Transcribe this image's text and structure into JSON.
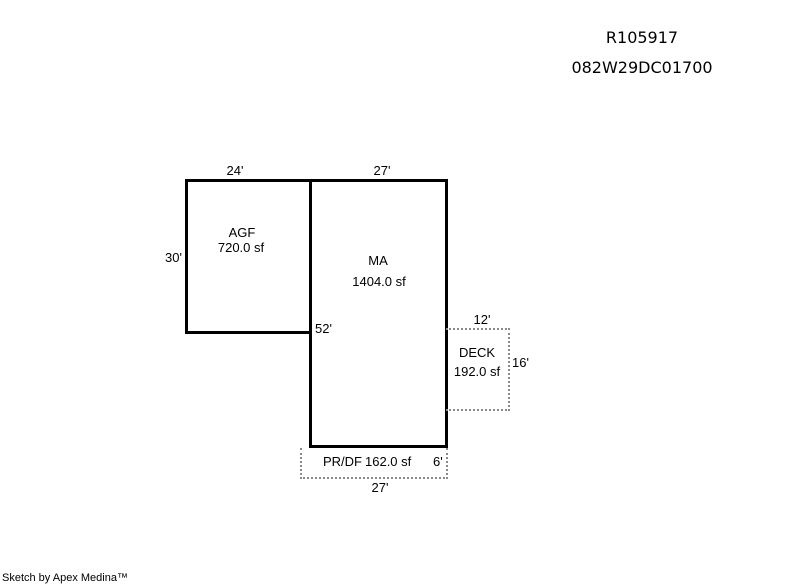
{
  "header": {
    "account_number": "R105917",
    "map_taxlot": "082W29DC01700"
  },
  "sketch": {
    "colors": {
      "background": "#ffffff",
      "solid_outline": "#000000",
      "dotted_outline": "#8a8a8a",
      "label_text": "#000000"
    },
    "agf": {
      "label": "AGF",
      "area": "720.0 sf",
      "width_dim": "24'",
      "height_dim": "30'"
    },
    "ma": {
      "label": "MA",
      "area": "1404.0 sf",
      "width_dim": "27'",
      "height_dim": "52'"
    },
    "deck": {
      "label": "DECK",
      "area": "192.0 sf",
      "width_dim": "12'",
      "height_dim": "16'"
    },
    "prdf": {
      "label": "PR/DF",
      "area": "162.0 sf",
      "height_dim": "6'",
      "width_dim": "27'"
    }
  },
  "footer": {
    "credit": "Sketch by Apex Medina™"
  }
}
